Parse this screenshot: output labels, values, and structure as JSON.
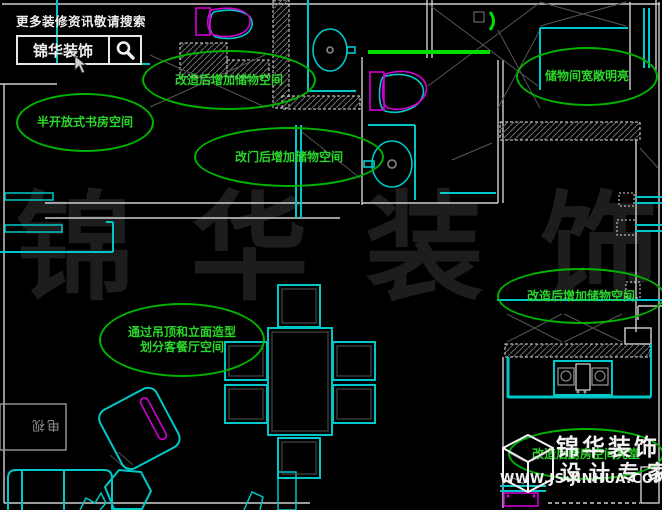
{
  "meta": {
    "app": "CAD floor plan render",
    "width": 662,
    "height": 510,
    "background": "#000000"
  },
  "colors": {
    "wall_cyan": "#00c8c8",
    "line_white": "#cfcfcf",
    "line_gray": "#555555",
    "fixture_magenta": "#d400d4",
    "annotation_green": "#00b400",
    "annotation_text_green": "#2bd62b",
    "highlight_green": "#00dd00",
    "watermark_gray": "#1d1d1d"
  },
  "search_banner": {
    "tagline": "更多装修资讯敬请搜索",
    "brand": "锦华装饰",
    "icon": "magnifier-icon"
  },
  "watermark": {
    "chars": [
      "锦",
      "华",
      "装",
      "饰"
    ]
  },
  "annotations": [
    {
      "id": "study",
      "lines": [
        "半开放式书房空间"
      ]
    },
    {
      "id": "storage-top",
      "lines": [
        "改造后增加储物空间"
      ]
    },
    {
      "id": "storage-door",
      "lines": [
        "改门后增加储物空间"
      ]
    },
    {
      "id": "closet-bright",
      "lines": [
        "储物间宽敞明亮"
      ]
    },
    {
      "id": "storage-right",
      "lines": [
        "改造后增加储物空间"
      ]
    },
    {
      "id": "living-zoning",
      "lines": [
        "通过吊顶和立面造型",
        "划分客餐厅空间"
      ]
    },
    {
      "id": "kitchen-bright",
      "lines": [
        "改造后厨房空间亮堂"
      ]
    }
  ],
  "furniture": {
    "tv_cabinet_label": "电视"
  },
  "logo": {
    "brand": "锦华装饰",
    "subtitle": "设计专家",
    "website": "WWW.JS-JINHUA.COM",
    "icon": "cube-logo-icon"
  }
}
